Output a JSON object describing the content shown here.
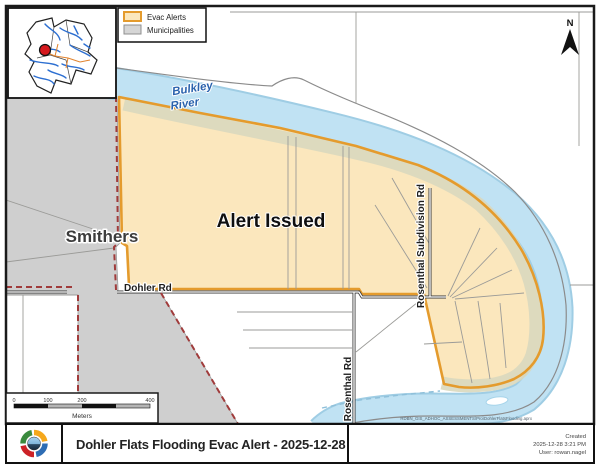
{
  "legend": {
    "items": [
      {
        "label": "Evac Alerts",
        "fill": "#FBE7BD",
        "border": "#E49B2D"
      },
      {
        "label": "Municipalities",
        "fill": "#D6D6D6",
        "border": "#8F8F8F"
      }
    ]
  },
  "north": {
    "label": "N"
  },
  "map_labels": {
    "city": "Smithers",
    "alert_status": "Alert Issued",
    "river_1": "Bulkley",
    "river_2": "River",
    "dohler_rd": "Dohler Rd",
    "rosenthal_subdivision_rd": "Rosenthal Subdivision Rd",
    "rosenthal_rd": "Rosenthal Rd",
    "credit": "RDBN_GIS_ADHOC_ASSESSMENTS\\Pro\\DohlerFlatsFlooding.aprx"
  },
  "scale_bar": {
    "tick_0": "0",
    "tick_100": "100",
    "tick_200": "200",
    "tick_400": "400",
    "unit": "Meters"
  },
  "footer": {
    "title": "Dohler Flats Flooding Evac Alert - 2025-12-28",
    "created_label": "Created",
    "created_datetime": "2025-12-28 3:21 PM",
    "created_user": "User: rowan.nagel"
  },
  "colors": {
    "evac_fill": "#FBE7BD",
    "evac_border": "#E49B2D",
    "municipality_fill": "#CFCFCF",
    "river": "#C0E2F3",
    "riparian_band": "#D9D8BE",
    "boundary_dash": "#A03B3B"
  }
}
